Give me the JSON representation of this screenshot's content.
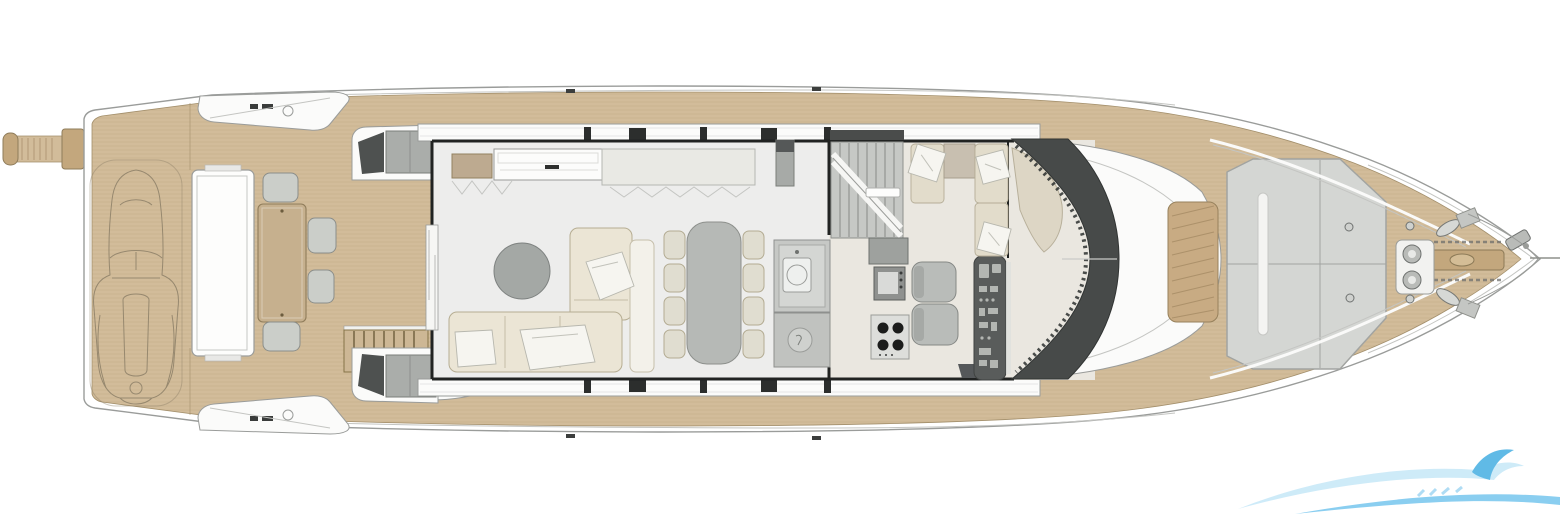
{
  "page": {
    "background": "#ffffff"
  },
  "plan": {
    "title": "motor-yacht-main-deck-floor-plan",
    "orientation": "bow-right",
    "zones": [
      "passerelle",
      "swim-platform-with-tender",
      "aft-cockpit",
      "salon-lounge",
      "dining-area",
      "galley",
      "stairs-to-lower-deck",
      "lower-helm-station",
      "dinette",
      "windshield",
      "foredeck-sun-pad",
      "bow-anchor-area"
    ],
    "furniture_counts": {
      "dining_chairs": 8,
      "cockpit_chairs": 4,
      "helm_seats": 2,
      "cooktop_burners": 4,
      "deck_pillows": 3,
      "sun_pads": 1
    }
  },
  "palette": {
    "teak": "#d2bc9a",
    "teak_edge": "#a38f6b",
    "teak_dark": "#c3a77d",
    "plank": "#8a6f49",
    "line_gray": "#9a9c9a",
    "line_light": "#c4c5c2",
    "wall_dark": "#212322",
    "floor_salon": "#ededec",
    "floor_fwd": "#eae7e0",
    "sofa": "#ebe5d5",
    "sofa_edge": "#b6ad92",
    "chair_cream": "#e0ddd0",
    "chair_edge": "#b3ab92",
    "table_gray": "#b6b9b6",
    "coffee_gray": "#a4a8a5",
    "cockpit_table": "#c6b08e",
    "cockpit_chair": "#cbcec9",
    "appliance": "#c6c8c5",
    "appliance_dark": "#8f918f",
    "burner": "#1c1d1c",
    "console": "#595c5b",
    "console_light": "#b3b6b2",
    "windshield": "#474a49",
    "sunpad": "#d4d6d3",
    "sunpad_line": "#a2a4a1",
    "bench_cream": "#e2dccb",
    "pillow": "#f6f5f0",
    "taupe": "#c8bfb0",
    "metal": "#b9bbb8",
    "white_part": "#fbfbfa"
  },
  "watermark": {
    "wave_light": "#c9e9f8",
    "wave_mid": "#7ec9ef",
    "wave_deep": "#4fb3e4"
  }
}
